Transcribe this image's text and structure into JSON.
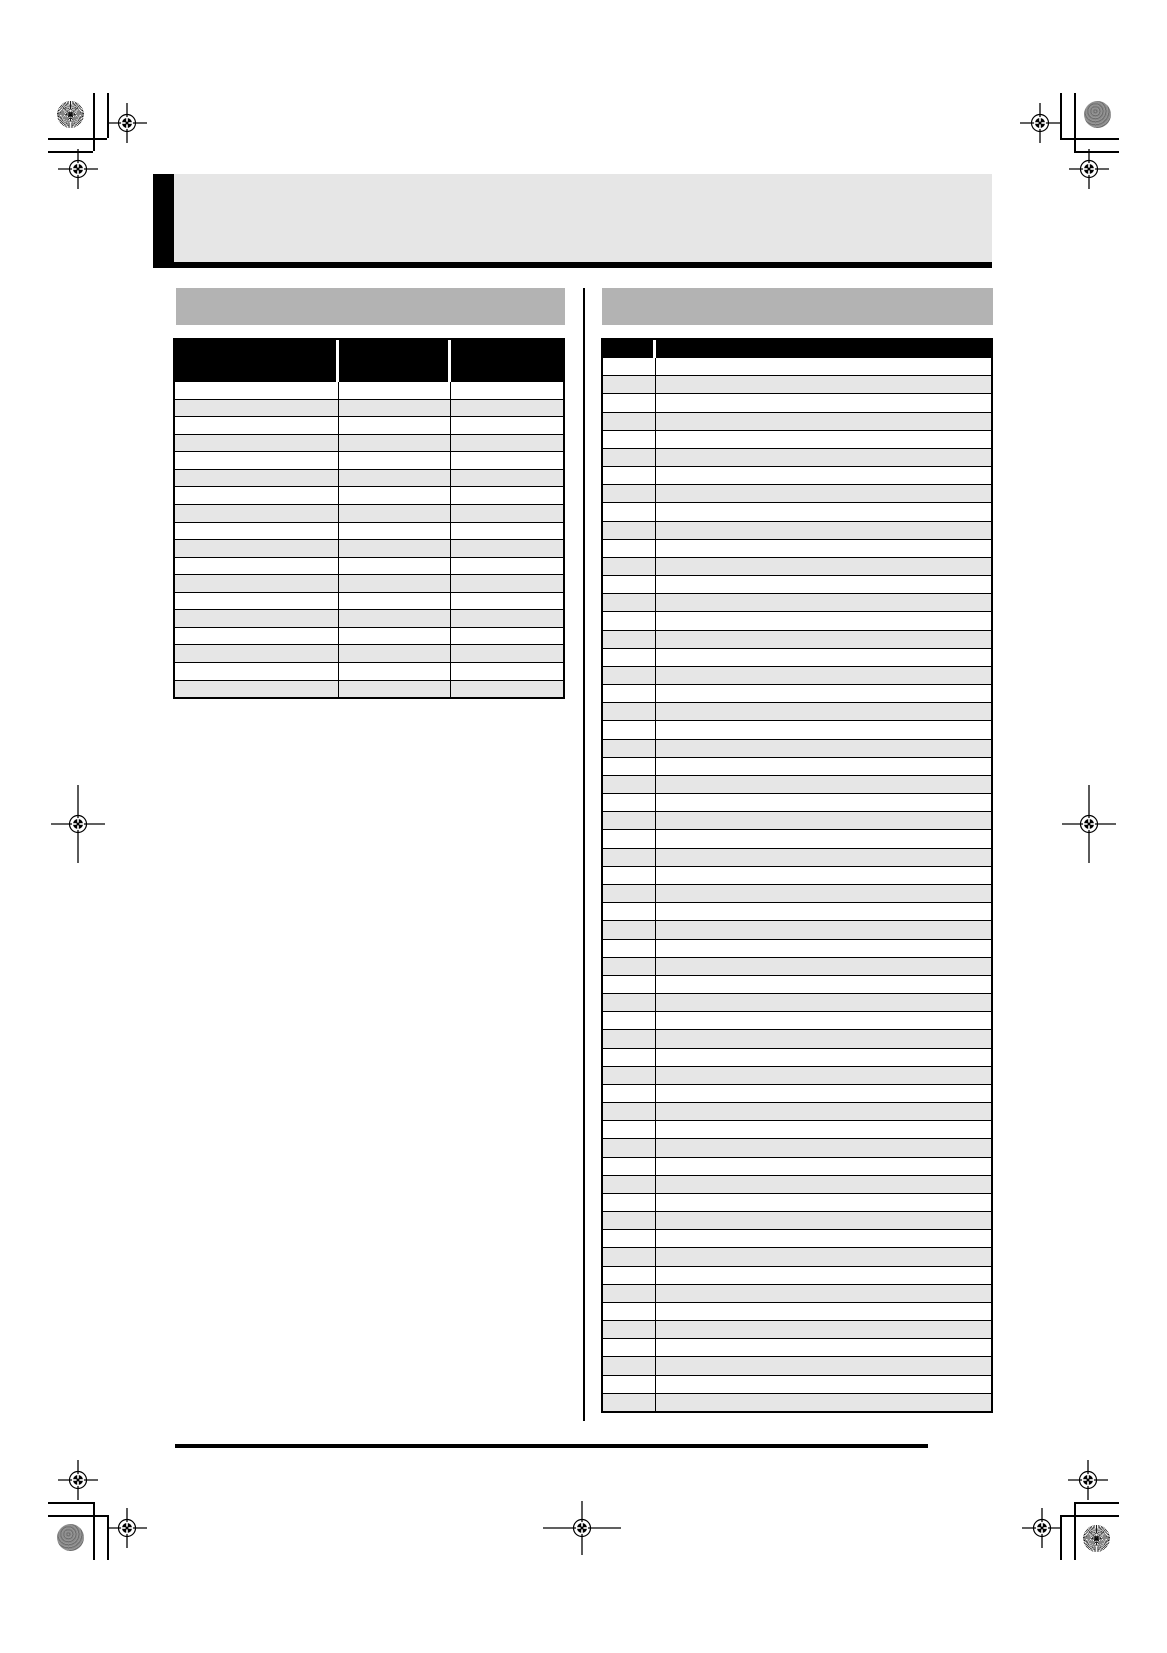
{
  "page": {
    "kind": "print-ready blank manual page with two empty tables",
    "colors": {
      "paper": "#ffffff",
      "ink": "#000000",
      "header_band_gray": "#e6e6e6",
      "section_bar_gray": "#b3b3b3",
      "row_alt_gray": "#e6e6e6"
    }
  },
  "header": {
    "title": ""
  },
  "sections": {
    "left": {
      "title": ""
    },
    "right": {
      "title": ""
    }
  },
  "tables": {
    "left": {
      "column_count": 3,
      "header_cells": [
        "",
        "",
        ""
      ],
      "data_row_count": 18,
      "zebra": [
        "#ffffff",
        "#e6e6e6"
      ]
    },
    "right": {
      "column_count": 2,
      "header_cells": [
        "",
        ""
      ],
      "data_row_count": 58,
      "zebra": [
        "#ffffff",
        "#e6e6e6"
      ]
    }
  },
  "printer_marks": {
    "registration_marks": [
      {
        "cx": 127,
        "cy": 123,
        "axis": "normal"
      },
      {
        "cx": 78,
        "cy": 169,
        "axis": "normal"
      },
      {
        "cx": 1040,
        "cy": 123,
        "axis": "normal"
      },
      {
        "cx": 1089,
        "cy": 169,
        "axis": "normal"
      },
      {
        "cx": 78,
        "cy": 1480,
        "axis": "normal"
      },
      {
        "cx": 127,
        "cy": 1528,
        "axis": "normal"
      },
      {
        "cx": 1088,
        "cy": 1480,
        "axis": "normal"
      },
      {
        "cx": 1042,
        "cy": 1528,
        "axis": "normal"
      },
      {
        "cx": 78,
        "cy": 824,
        "axis": "vertical-long"
      },
      {
        "cx": 1089,
        "cy": 824,
        "axis": "vertical-long"
      },
      {
        "cx": 582,
        "cy": 1528,
        "axis": "horizontal-long"
      }
    ],
    "color_targets": [
      {
        "cx": 70,
        "cy": 114,
        "style": "starburst"
      },
      {
        "cx": 1097,
        "cy": 114,
        "style": "halftone"
      },
      {
        "cx": 70,
        "cy": 1537,
        "style": "halftone"
      },
      {
        "cx": 1096,
        "cy": 1538,
        "style": "starburst"
      }
    ],
    "crop_lines": [
      {
        "x": 93,
        "y": 93,
        "w": 1,
        "h": 58
      },
      {
        "x": 107,
        "y": 93,
        "w": 1,
        "h": 45
      },
      {
        "x": 48,
        "y": 138,
        "w": 59,
        "h": 1
      },
      {
        "x": 48,
        "y": 151,
        "w": 45,
        "h": 1
      },
      {
        "x": 1074,
        "y": 93,
        "w": 1,
        "h": 58
      },
      {
        "x": 1060,
        "y": 93,
        "w": 1,
        "h": 45
      },
      {
        "x": 1060,
        "y": 138,
        "w": 59,
        "h": 1
      },
      {
        "x": 1074,
        "y": 151,
        "w": 45,
        "h": 1
      },
      {
        "x": 93,
        "y": 1502,
        "w": 1,
        "h": 58
      },
      {
        "x": 107,
        "y": 1515,
        "w": 1,
        "h": 45
      },
      {
        "x": 48,
        "y": 1502,
        "w": 45,
        "h": 1
      },
      {
        "x": 48,
        "y": 1515,
        "w": 59,
        "h": 1
      },
      {
        "x": 1074,
        "y": 1502,
        "w": 1,
        "h": 58
      },
      {
        "x": 1060,
        "y": 1515,
        "w": 1,
        "h": 45
      },
      {
        "x": 1074,
        "y": 1502,
        "w": 45,
        "h": 1
      },
      {
        "x": 1060,
        "y": 1515,
        "w": 59,
        "h": 1
      }
    ]
  }
}
